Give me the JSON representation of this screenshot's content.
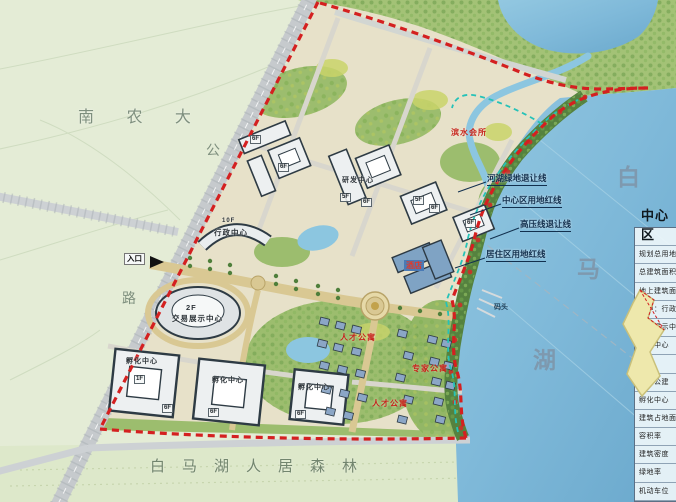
{
  "map": {
    "campus_label": "南 农 大",
    "road_name_chars": [
      "公",
      "路"
    ],
    "forest_label": "白马湖人居森林",
    "lake_name_chars": [
      "白",
      "马",
      "湖"
    ],
    "entrance_label": "入口",
    "dock_label": "码头",
    "setback_labels": [
      "河湖绿地退让线",
      "中心区用地红线",
      "高压线退让线",
      "居住区用地红线"
    ],
    "red_zone_labels": [
      "滨水会所",
      "人才公寓",
      "专家公寓",
      "人才公寓"
    ],
    "building_labels": {
      "admin_floor": "10F",
      "admin_name": "行政中心",
      "exhibition_floor": "2F",
      "exhibition_name": "交易展示中心",
      "incubator_name_1": "孵化中心",
      "incubator_name_2": "孵化中心",
      "incubator_name_3": "孵化中心",
      "rd_name": "研发中心",
      "hotel_name": "酒店"
    },
    "floor_tags": [
      "6F",
      "6F",
      "5F",
      "6F",
      "5F",
      "6F",
      "6F",
      "1F",
      "6F",
      "6F",
      "6F"
    ]
  },
  "legend": {
    "title": "中心区",
    "rows": [
      "名称",
      "规划总用地",
      "总建筑面积",
      "地上建筑面积",
      "其中：行政中心",
      "交易展示中心",
      "研发中心",
      "酒店",
      "配套公建",
      "孵化中心",
      "建筑占地面积",
      "容积率",
      "建筑密度",
      "绿地率",
      "机动车位"
    ]
  },
  "colors": {
    "boundary_red": "#d42020",
    "greenline_cyan": "#25c2b8",
    "lake_blue": "#7fb9d9",
    "park_green": "#a3c276"
  }
}
